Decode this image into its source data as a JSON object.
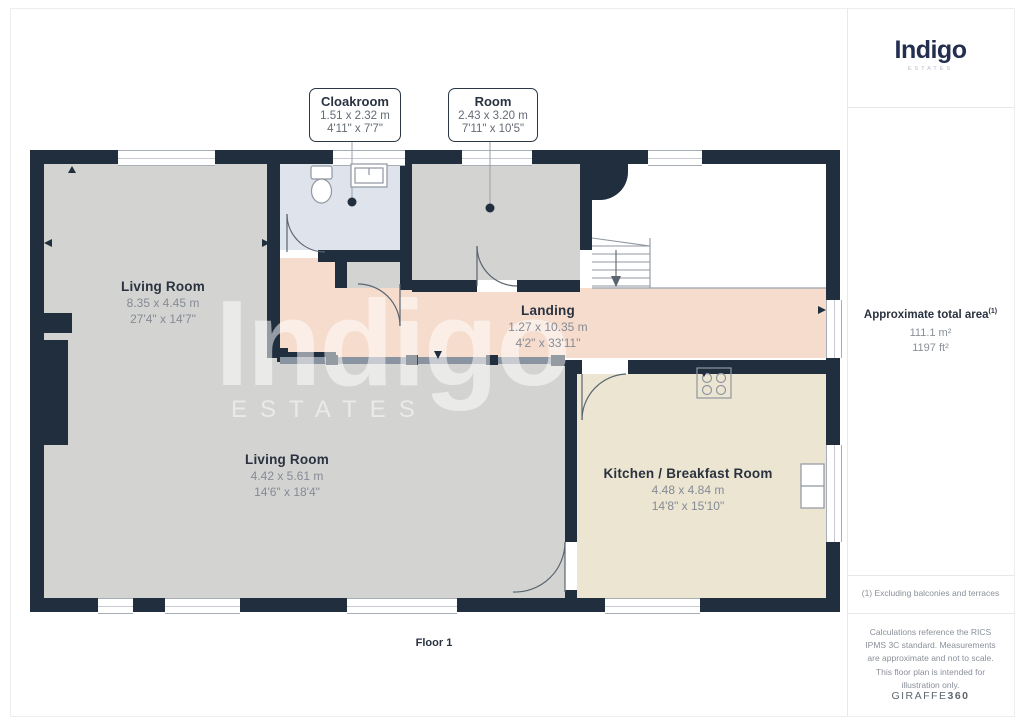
{
  "brand": {
    "name": "Indigo",
    "tagline": "ESTATES"
  },
  "watermark": {
    "text": "Indigo",
    "subtext": "ESTATES"
  },
  "plan": {
    "floor_label": "Floor 1",
    "rooms": [
      {
        "name": "Living Room",
        "metric": "8.35 x 4.45 m",
        "imperial": "27'4\" x 14'7\""
      },
      {
        "name": "Living Room",
        "metric": "4.42 x 5.61 m",
        "imperial": "14'6\" x 18'4\""
      },
      {
        "name": "Landing",
        "metric": "1.27 x 10.35 m",
        "imperial": "4'2\" x 33'11\""
      },
      {
        "name": "Kitchen / Breakfast Room",
        "metric": "4.48 x 4.84 m",
        "imperial": "14'8\" x 15'10\""
      }
    ],
    "callouts": [
      {
        "name": "Cloakroom",
        "metric": "1.51 x 2.32 m",
        "imperial": "4'11\" x 7'7\""
      },
      {
        "name": "Room",
        "metric": "2.43 x 3.20 m",
        "imperial": "7'11\" x 10'5\""
      }
    ]
  },
  "sidebar": {
    "area_title": "Approximate total area",
    "area_footnote_marker": "(1)",
    "area_metric": "111.1 m²",
    "area_imperial": "1197 ft²",
    "footnote": "(1) Excluding balconies and terraces",
    "disclaimer": "Calculations reference the RICS IPMS 3C standard. Measurements are approximate and not to scale. This floor plan is intended for illustration only.",
    "provider": {
      "name": "GIRAFFE",
      "suffix": "360"
    }
  },
  "colors": {
    "wall": "#212e3e",
    "room_floor": "#d3d3d1",
    "cloakroom_floor": "#dfe3ec",
    "landing_floor": "#f5dccd",
    "kitchen_floor": "#ece5d2",
    "brand_navy": "#242e50",
    "text_dark": "#2a3240",
    "text_muted": "#858b95"
  }
}
